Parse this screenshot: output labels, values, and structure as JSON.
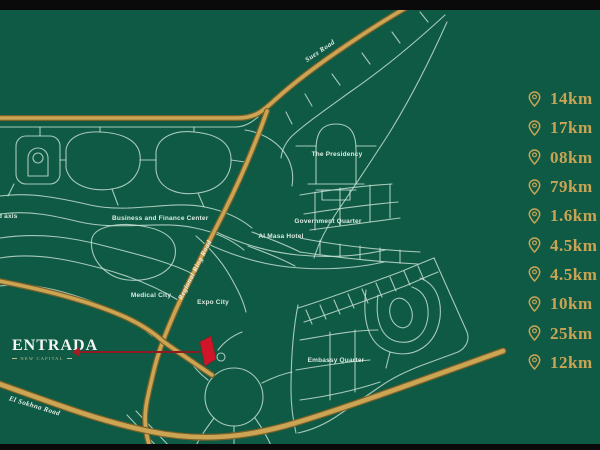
{
  "colors": {
    "background_green": "#0e5a44",
    "letterbox_black": "#0a0a0a",
    "road_gold": "#cba454",
    "road_white": "#c9e2d6",
    "accent_red": "#cf1527",
    "distance_gold": "#c9a455",
    "label_white": "#dcebe3"
  },
  "brand": {
    "name": "ENTRADA",
    "subtitle": "NEW CAPITAL"
  },
  "road_labels": {
    "suez_road": "Suez Road",
    "regional_ring_road": "Regional Ring Road",
    "el_sokhna_road": "El Sokhna Road"
  },
  "district_labels": {
    "the_presidency": "The Presidency",
    "business_and_finance_center": "Business and Finance Center",
    "government_quarter": "Government Quarter",
    "al_masa_hotel": "Al Masa Hotel",
    "medical_city": "Medical City",
    "expo_city": "Expo City",
    "embassy_quarter": "Embassy Quarter",
    "axis_label_partial": "d axis"
  },
  "distance_list": {
    "items": [
      {
        "icon": "location-pin-icon",
        "value": "14km"
      },
      {
        "icon": "location-pin-icon",
        "value": "17km"
      },
      {
        "icon": "location-pin-icon",
        "value": "08km"
      },
      {
        "icon": "location-pin-icon",
        "value": "79km"
      },
      {
        "icon": "location-pin-icon",
        "value": "1.6km"
      },
      {
        "icon": "location-pin-icon",
        "value": "4.5km"
      },
      {
        "icon": "location-pin-icon",
        "value": "4.5km"
      },
      {
        "icon": "location-pin-icon",
        "value": "10km"
      },
      {
        "icon": "location-pin-icon",
        "value": "25km"
      },
      {
        "icon": "location-pin-icon",
        "value": "12km"
      }
    ]
  }
}
